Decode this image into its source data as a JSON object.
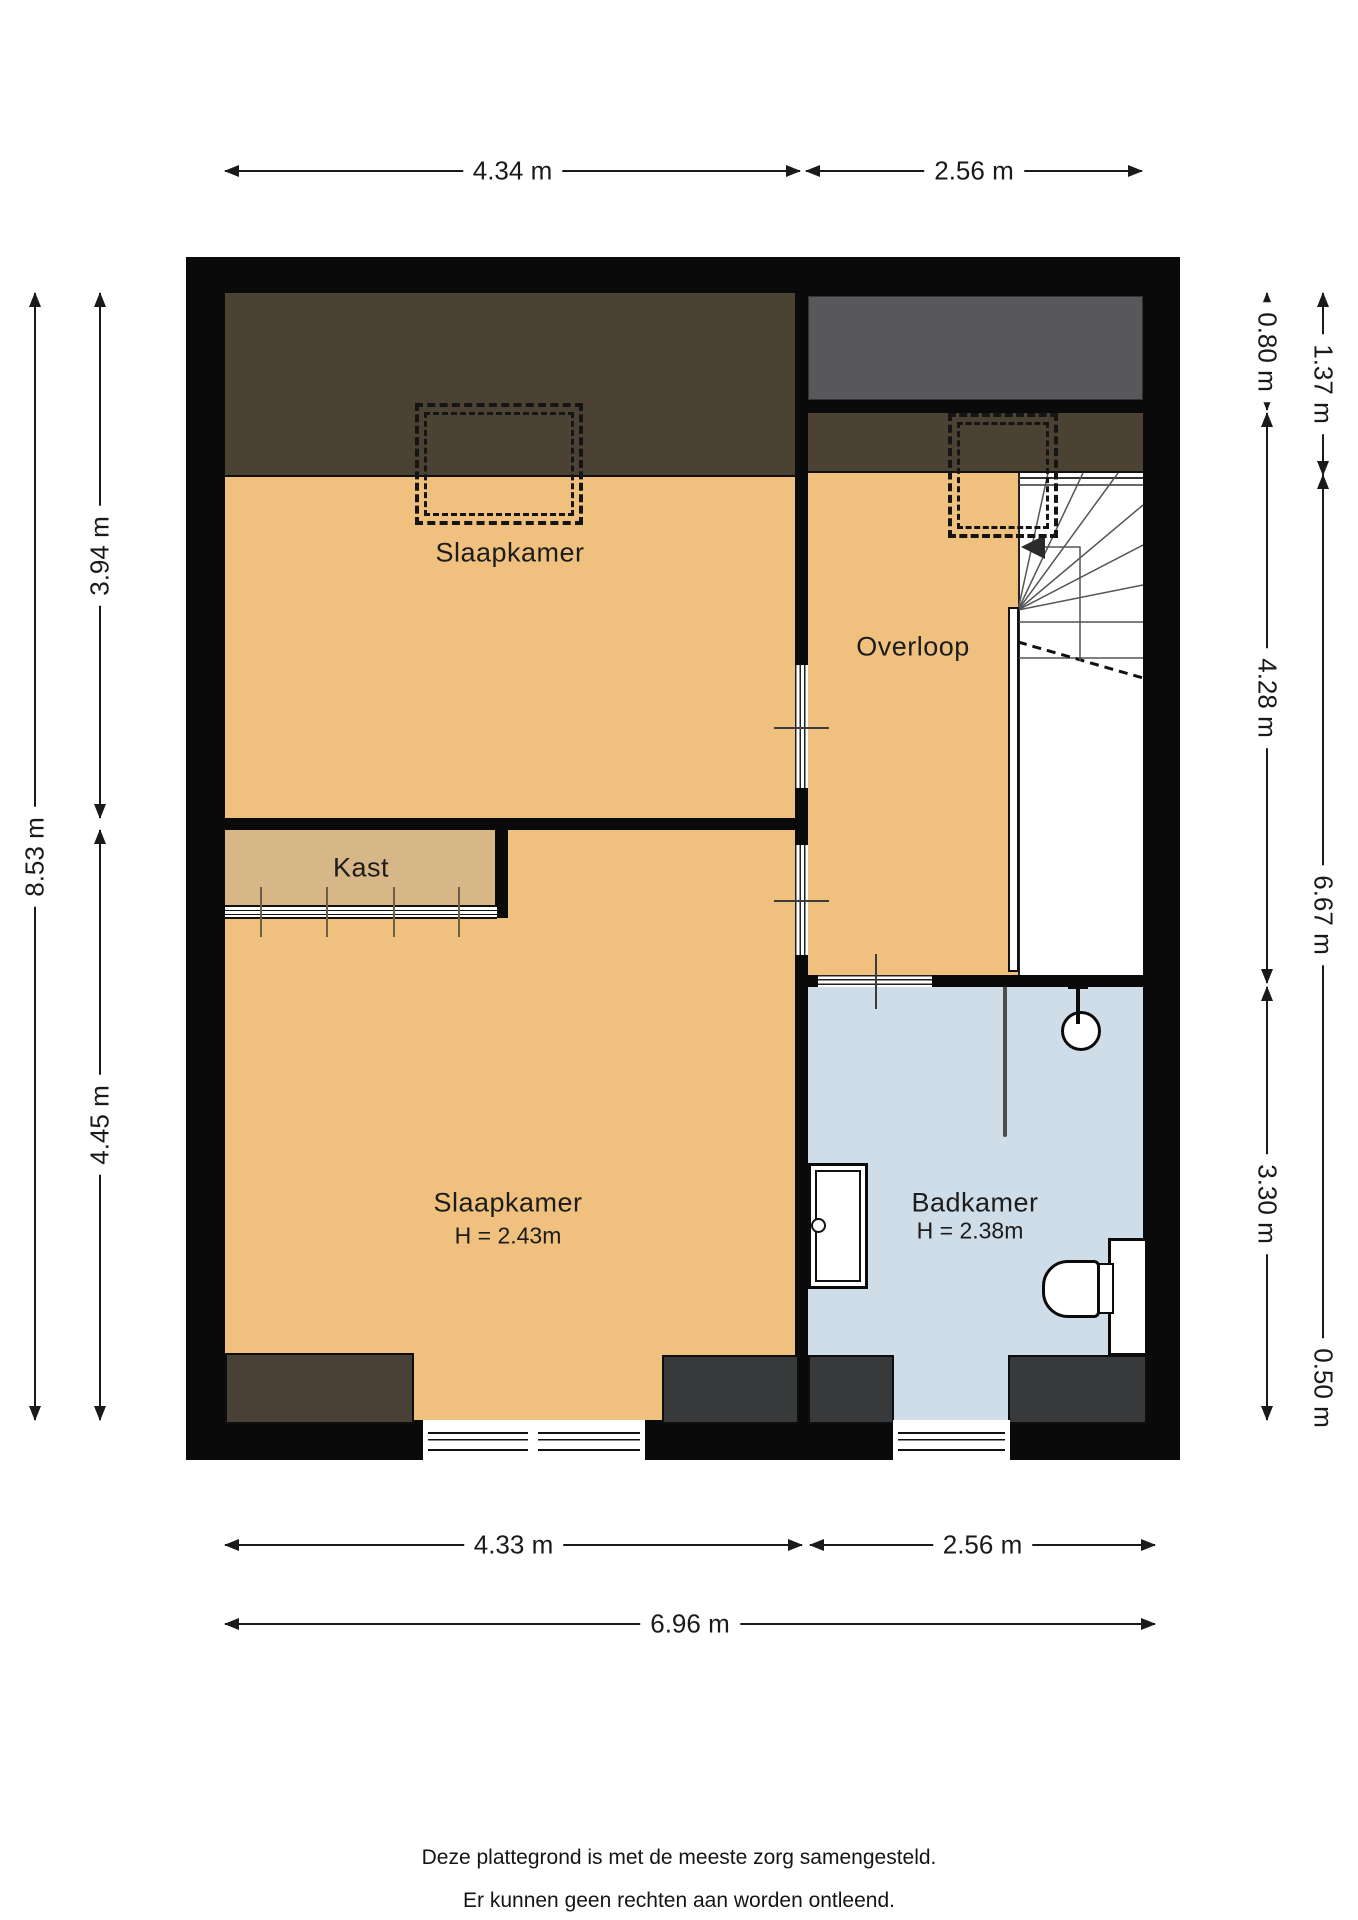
{
  "rooms": {
    "bedroom_top": {
      "name": "Slaapkamer"
    },
    "landing": {
      "name": "Overloop"
    },
    "closet": {
      "name": "Kast"
    },
    "bedroom_bottom": {
      "name": "Slaapkamer",
      "height": "H = 2.43m"
    },
    "bathroom": {
      "name": "Badkamer",
      "height": "H = 2.38m"
    }
  },
  "dimensions": {
    "top": [
      "4.34 m",
      "2.56 m"
    ],
    "bottom_split": [
      "4.33 m",
      "2.56 m"
    ],
    "bottom_total": "6.96 m",
    "left_outer": "8.53 m",
    "left_inner": [
      "3.94 m",
      "4.45 m"
    ],
    "right_inner": [
      "0.80 m",
      "4.28 m",
      "3.30 m"
    ],
    "right_outer": [
      "1.37 m",
      "6.67 m",
      "0.50 m"
    ]
  },
  "footer": {
    "line1": "Deze plattegrond is met de meeste zorg samengesteld.",
    "line2": "Er kunnen geen rechten aan worden ontleend."
  },
  "colors": {
    "wall": "#0a0a0a",
    "floor": "#f0c07e",
    "closet_floor": "#d7b687",
    "bathroom_floor": "#cfdde9",
    "roof": "#4b4234",
    "void_gray": "#58585a",
    "block_gray": "#37393b",
    "block_brown": "#494136",
    "dimc": "#1a1a1a"
  }
}
